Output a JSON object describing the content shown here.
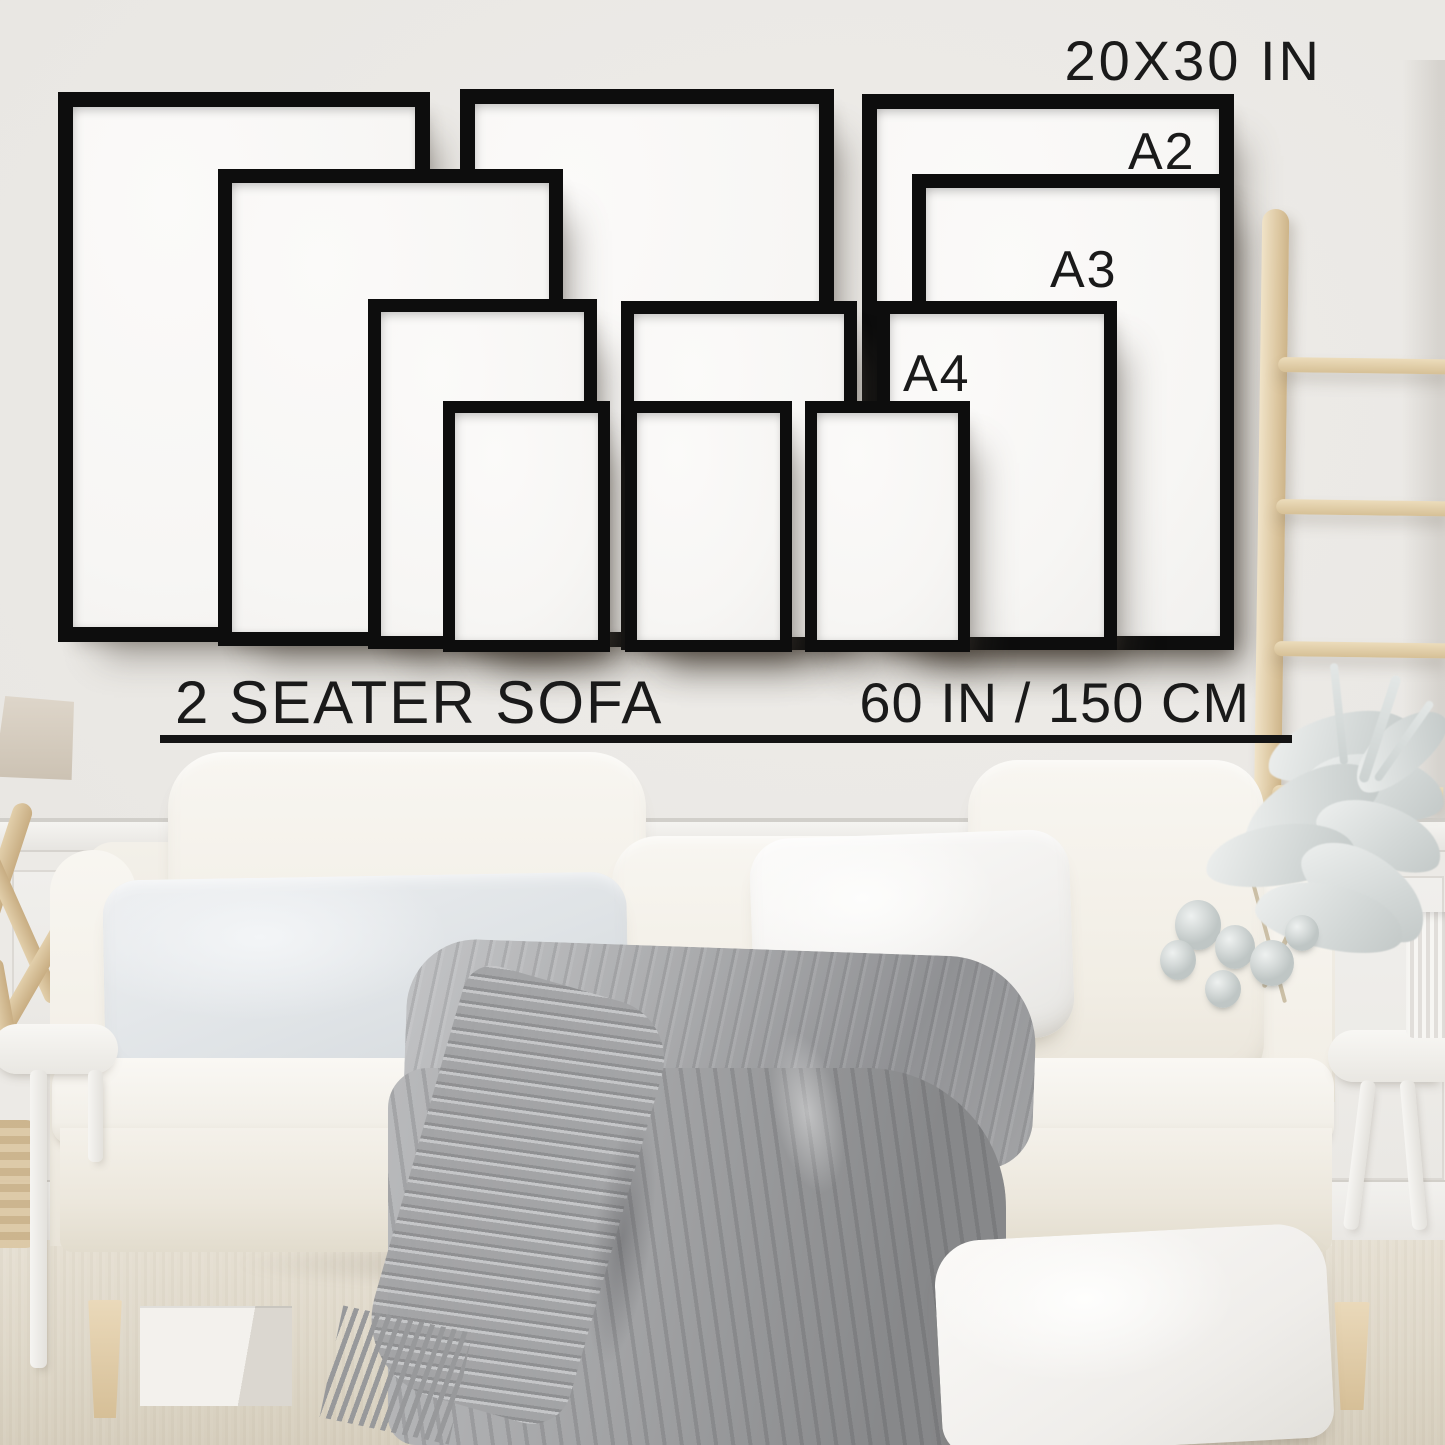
{
  "size_guide": {
    "heading": "20X30 IN",
    "frame_labels": {
      "a2": "A2",
      "a3": "A3",
      "a4": "A4"
    },
    "sofa": {
      "label": "2 SEATER SOFA",
      "width": "60 IN / 150 CM"
    },
    "frames": [
      {
        "size": "20x30 in",
        "row": "back",
        "position": "left"
      },
      {
        "size": "20x30 in",
        "row": "back",
        "position": "middle"
      },
      {
        "size": "20x30 in",
        "row": "back",
        "position": "right"
      },
      {
        "size": "A2",
        "row": "second",
        "position": "left"
      },
      {
        "size": "A2",
        "row": "second",
        "position": "right"
      },
      {
        "size": "A3",
        "row": "third",
        "position": "left"
      },
      {
        "size": "A3",
        "row": "third",
        "position": "middle"
      },
      {
        "size": "A3",
        "row": "third",
        "position": "right"
      },
      {
        "size": "A4",
        "row": "front",
        "position": "left"
      },
      {
        "size": "A4",
        "row": "front",
        "position": "middle"
      },
      {
        "size": "A4",
        "row": "front",
        "position": "right"
      }
    ]
  },
  "scene": {
    "items": [
      "white two-seater sofa",
      "cream back cushions",
      "light gray pillow",
      "white pillow",
      "gray cable-knit throw blanket",
      "wooden blanket ladder",
      "dried white plant in ribbed vase",
      "white round side tables",
      "table lamp shade",
      "driftwood sculpture",
      "wicker basket",
      "beige carpet",
      "storage boxes under sofa",
      "white floor pillow",
      "wainscoting wall panels"
    ]
  },
  "colors": {
    "wall": "#e9e7e3",
    "frame": "#0d0d0d",
    "paper": "#f7f6f4",
    "ink": "#1a1a1a",
    "sofa": "#f4f1ea",
    "blanket": "#a9aaac",
    "wood": "#e6d3ae",
    "carpet": "#e0d9cb"
  }
}
